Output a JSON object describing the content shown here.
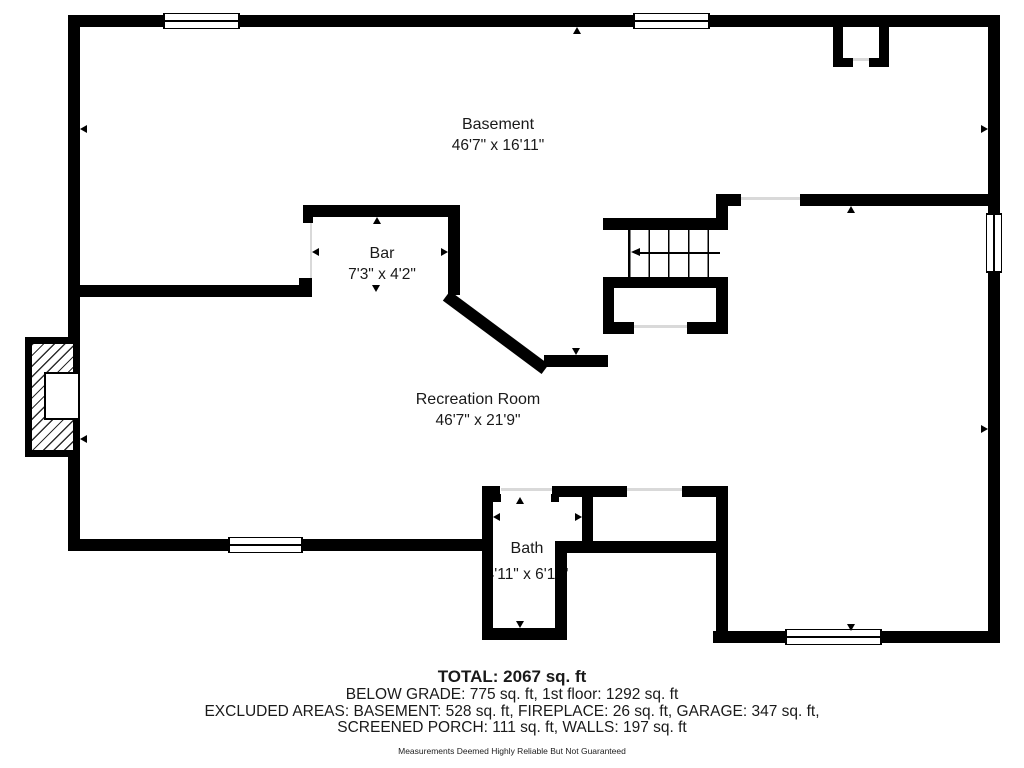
{
  "plan": {
    "title": "Basement floor plan",
    "rooms": [
      {
        "name": "Basement",
        "dims": "46'7\" x 16'11\""
      },
      {
        "name": "Bar",
        "dims": "7'3\" x 4'2\""
      },
      {
        "name": "Recreation Room",
        "dims": "46'7\" x 21'9\""
      },
      {
        "name": "Bath",
        "dims": "4'11\" x 6'11\""
      }
    ],
    "symbols": [
      "window",
      "staircase",
      "fireplace",
      "chimney",
      "measurement-arrows"
    ]
  },
  "footer": {
    "total": "TOTAL: 2067 sq. ft",
    "below_grade": "BELOW GRADE: 775 sq. ft, 1st floor: 1292 sq. ft",
    "excluded_1": "EXCLUDED AREAS: BASEMENT: 528 sq. ft, FIREPLACE: 26 sq. ft, GARAGE: 347 sq. ft,",
    "excluded_2": "SCREENED PORCH: 111 sq. ft, WALLS: 197 sq. ft",
    "disclaimer": "Measurements Deemed Highly Reliable But Not Guaranteed"
  },
  "colors": {
    "wall": "#000000",
    "opening_line": "#d9d9d9",
    "background": "#ffffff"
  }
}
